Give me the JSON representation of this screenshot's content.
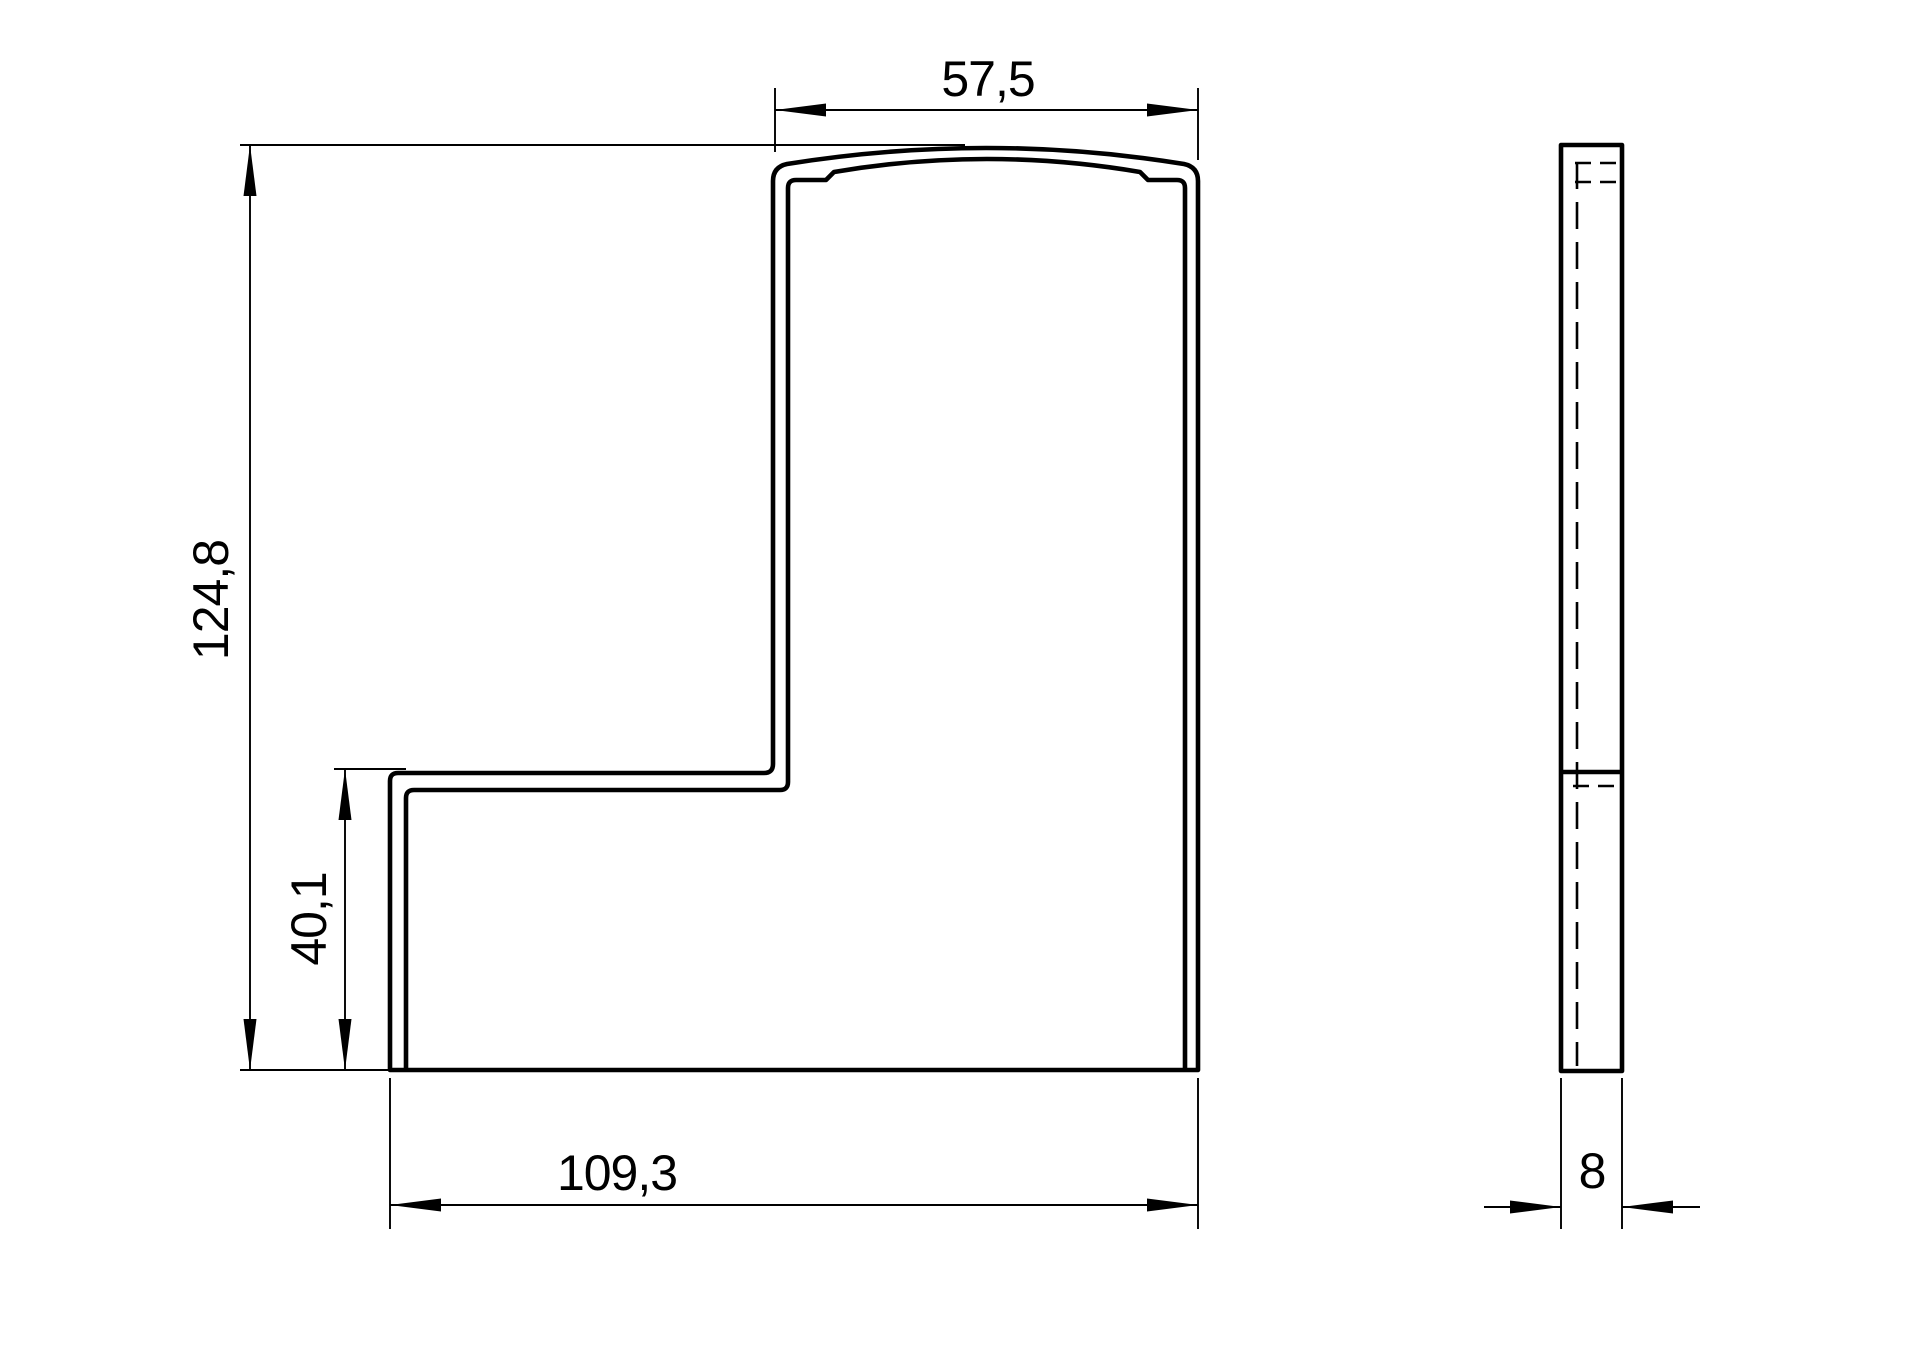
{
  "drawing": {
    "type": "technical-dimension-drawing",
    "views": {
      "front": {
        "label": "front-profile-view"
      },
      "side": {
        "label": "side-thickness-view"
      }
    },
    "dimensions": {
      "top_width": "57,5",
      "overall_height": "124,8",
      "step_height": "40,1",
      "overall_width": "109,3",
      "thickness": "8"
    },
    "colors": {
      "line": "#000000",
      "background": "#ffffff"
    }
  }
}
